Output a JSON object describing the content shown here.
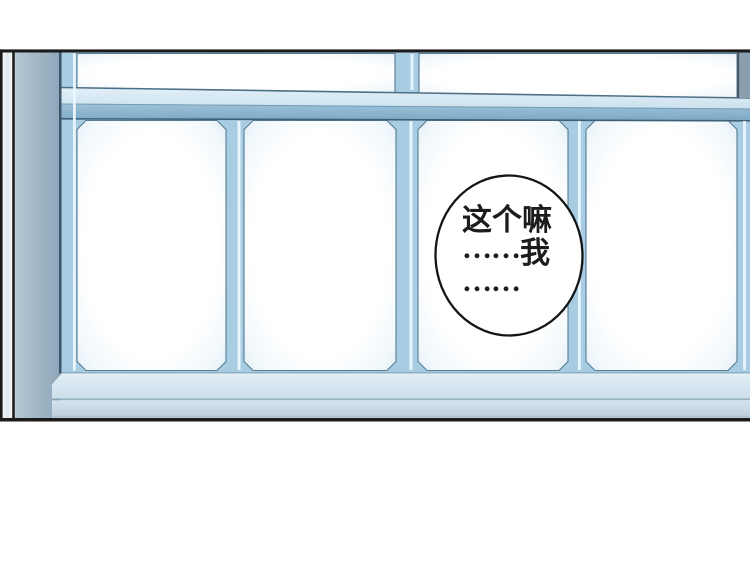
{
  "bubble": {
    "line1": "这个嘛",
    "line2_ellipsis": "……",
    "line2_text": "我",
    "line3_ellipsis": "……"
  },
  "colors": {
    "outline_black": "#1b1b1b",
    "frame_blue": "#a8cce2",
    "rail_light_blue": "#d8e9f3",
    "pillar_gray_blue": "#a3b8c8",
    "sill_light_blue": "#d4e3ee",
    "glass_white": "#ffffff",
    "highlight_blue": "#eaf7fe",
    "bubble_fill": "#ffffff"
  }
}
